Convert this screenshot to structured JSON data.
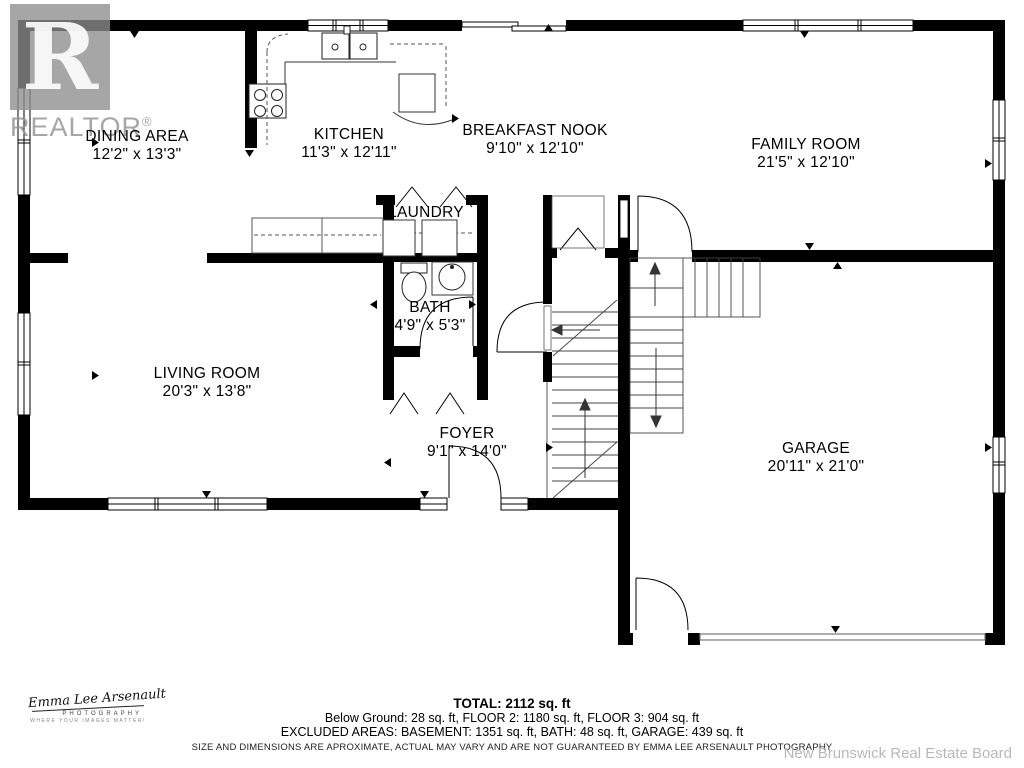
{
  "watermark": {
    "letter": "R",
    "brand": "REALTOR",
    "reg": "®"
  },
  "rooms": {
    "dining": {
      "name": "DINING AREA",
      "dims": "12'2\" x 13'3\""
    },
    "kitchen": {
      "name": "KITCHEN",
      "dims": "11'3\" x 12'11\""
    },
    "nook": {
      "name": "BREAKFAST NOOK",
      "dims": "9'10\" x 12'10\""
    },
    "family": {
      "name": "FAMILY ROOM",
      "dims": "21'5\" x 12'10\""
    },
    "laundry": {
      "name": "LAUNDRY"
    },
    "bath": {
      "name": "BATH",
      "dims": "4'9\" x 5'3\""
    },
    "living": {
      "name": "LIVING ROOM",
      "dims": "20'3\" x 13'8\""
    },
    "foyer": {
      "name": "FOYER",
      "dims": "9'1\" x 14'0\""
    },
    "garage": {
      "name": "GARAGE",
      "dims": "20'11\" x 21'0\""
    }
  },
  "summary": {
    "total": "TOTAL: 2112 sq. ft",
    "floors": "Below Ground: 28 sq. ft, FLOOR 2: 1180 sq. ft, FLOOR 3: 904 sq. ft",
    "excluded": "EXCLUDED AREAS: BASEMENT: 1351 sq. ft, BATH: 48 sq. ft, GARAGE: 439 sq. ft",
    "disclaimer": "SIZE AND DIMENSIONS ARE APROXIMATE, ACTUAL MAY VARY AND ARE NOT GUARANTEED BY EMMA LEE ARSENAULT PHOTOGRAPHY"
  },
  "credits": {
    "signature": "Emma Lee Arsenault",
    "sub": "PHOTOGRAPHY",
    "tagline": "WHERE YOUR IMAGES MATTER!",
    "board": "New Brunswick Real Estate Board"
  },
  "colors": {
    "wall": "#000000",
    "watermark_gray": "#8d8d8d",
    "footer_gray": "#b8b8b8"
  }
}
